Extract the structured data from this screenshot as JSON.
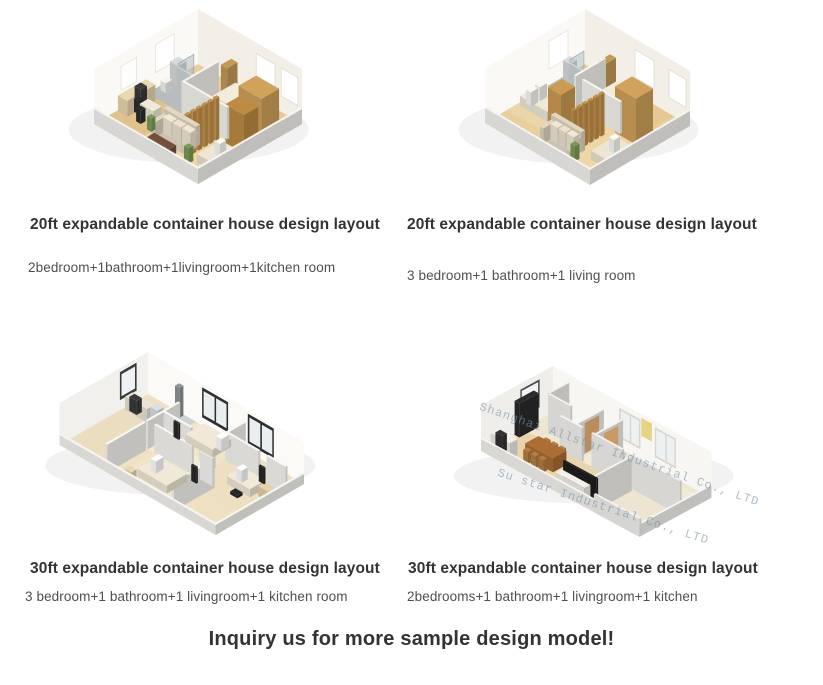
{
  "cards": [
    {
      "title": "20ft expandable container house design layout",
      "desc": "2bedroom+1bathroom+1livingroom+1kitchen room"
    },
    {
      "title": "20ft expandable container house design layout",
      "desc": "3 bedroom+1 bathroom+1 living room"
    },
    {
      "title": "30ft expandable container house design layout",
      "desc": "3 bedroom+1 bathroom+1 livingroom+1 kitchen room"
    },
    {
      "title": "30ft expandable container house design layout",
      "desc": "2bedrooms+1 bathroom+1 livingroom+1 kitchen"
    }
  ],
  "cta": "Inquiry us for more sample design model!",
  "watermark": {
    "line1": "Shanghai Allstar Industrial Co., LTD",
    "line2": "Su star Industrial Co., LTD"
  },
  "colors": {
    "heading": "#333333",
    "body_text": "#4f4f4f",
    "background": "#ffffff",
    "wood_floor": "#e9cf9e",
    "wood_furniture": "#d0a25c",
    "wall_white": "#f6f4ee"
  }
}
